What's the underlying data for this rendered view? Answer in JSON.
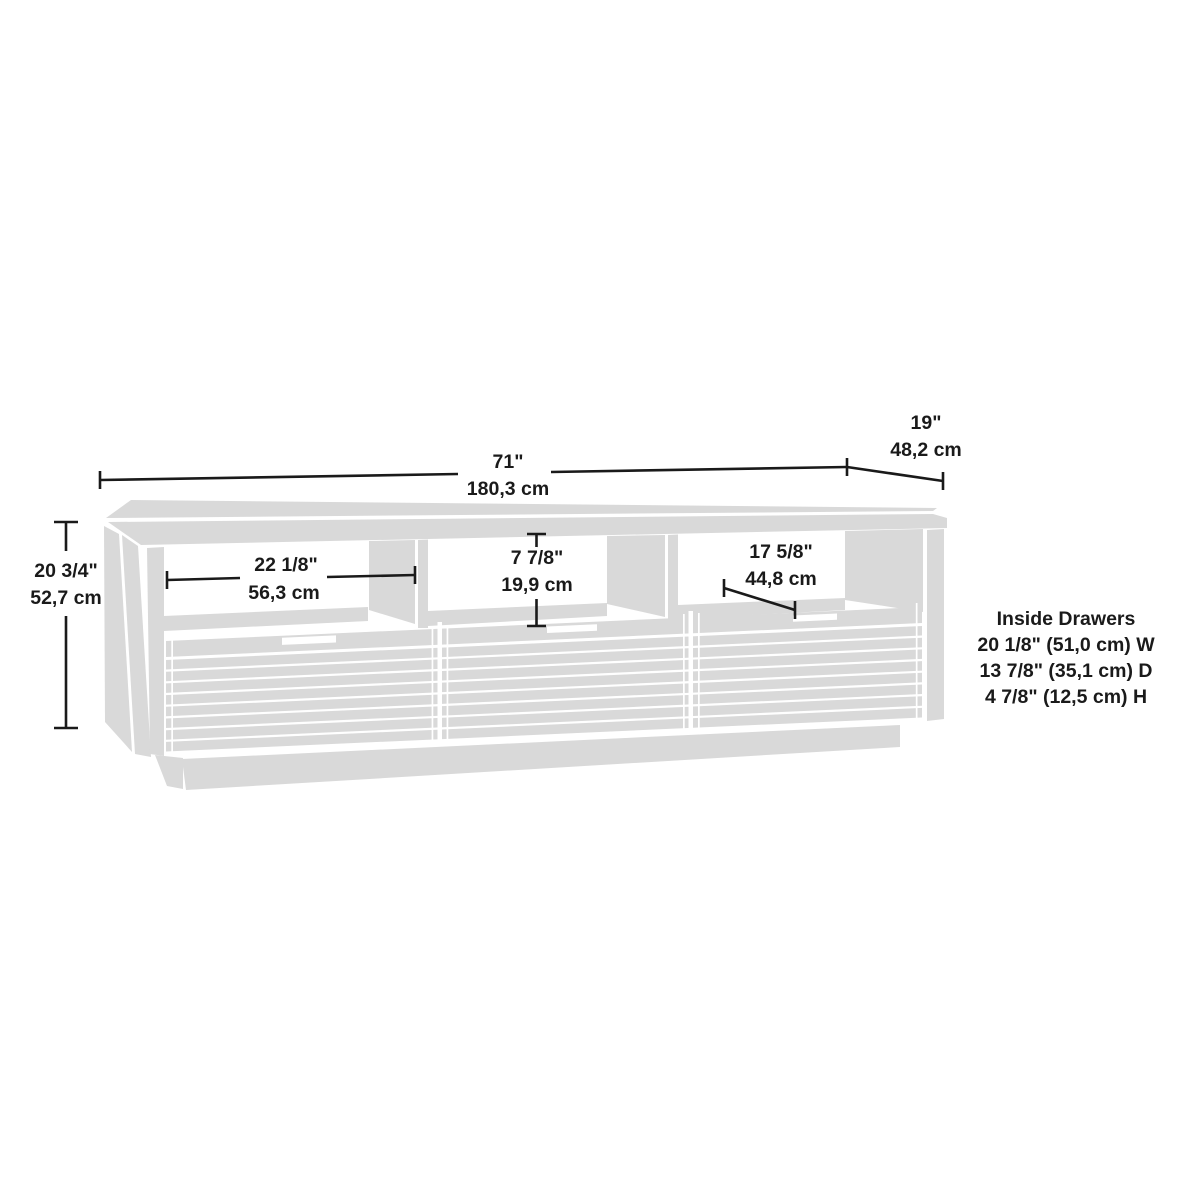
{
  "dimensions": {
    "overall_width": {
      "inches": "71\"",
      "cm": "180,3 cm"
    },
    "overall_depth": {
      "inches": "19\"",
      "cm": "48,2 cm"
    },
    "overall_height": {
      "inches": "20 3/4\"",
      "cm": "52,7 cm"
    },
    "left_cubby": {
      "inches": "22 1/8\"",
      "cm": "56,3 cm"
    },
    "center_cubby": {
      "inches": "7 7/8\"",
      "cm": "19,9 cm"
    },
    "right_cubby": {
      "inches": "17 5/8\"",
      "cm": "44,8 cm"
    }
  },
  "inside_drawers": {
    "title": "Inside Drawers",
    "width_line": "20 1/8\" (51,0 cm) W",
    "depth_line": "13 7/8\" (35,1 cm) D",
    "height_line": "4 7/8\" (12,5 cm) H"
  },
  "colors": {
    "background": "#ffffff",
    "furniture_fill": "#d9d9d9",
    "annotation": "#1a1a1a"
  }
}
